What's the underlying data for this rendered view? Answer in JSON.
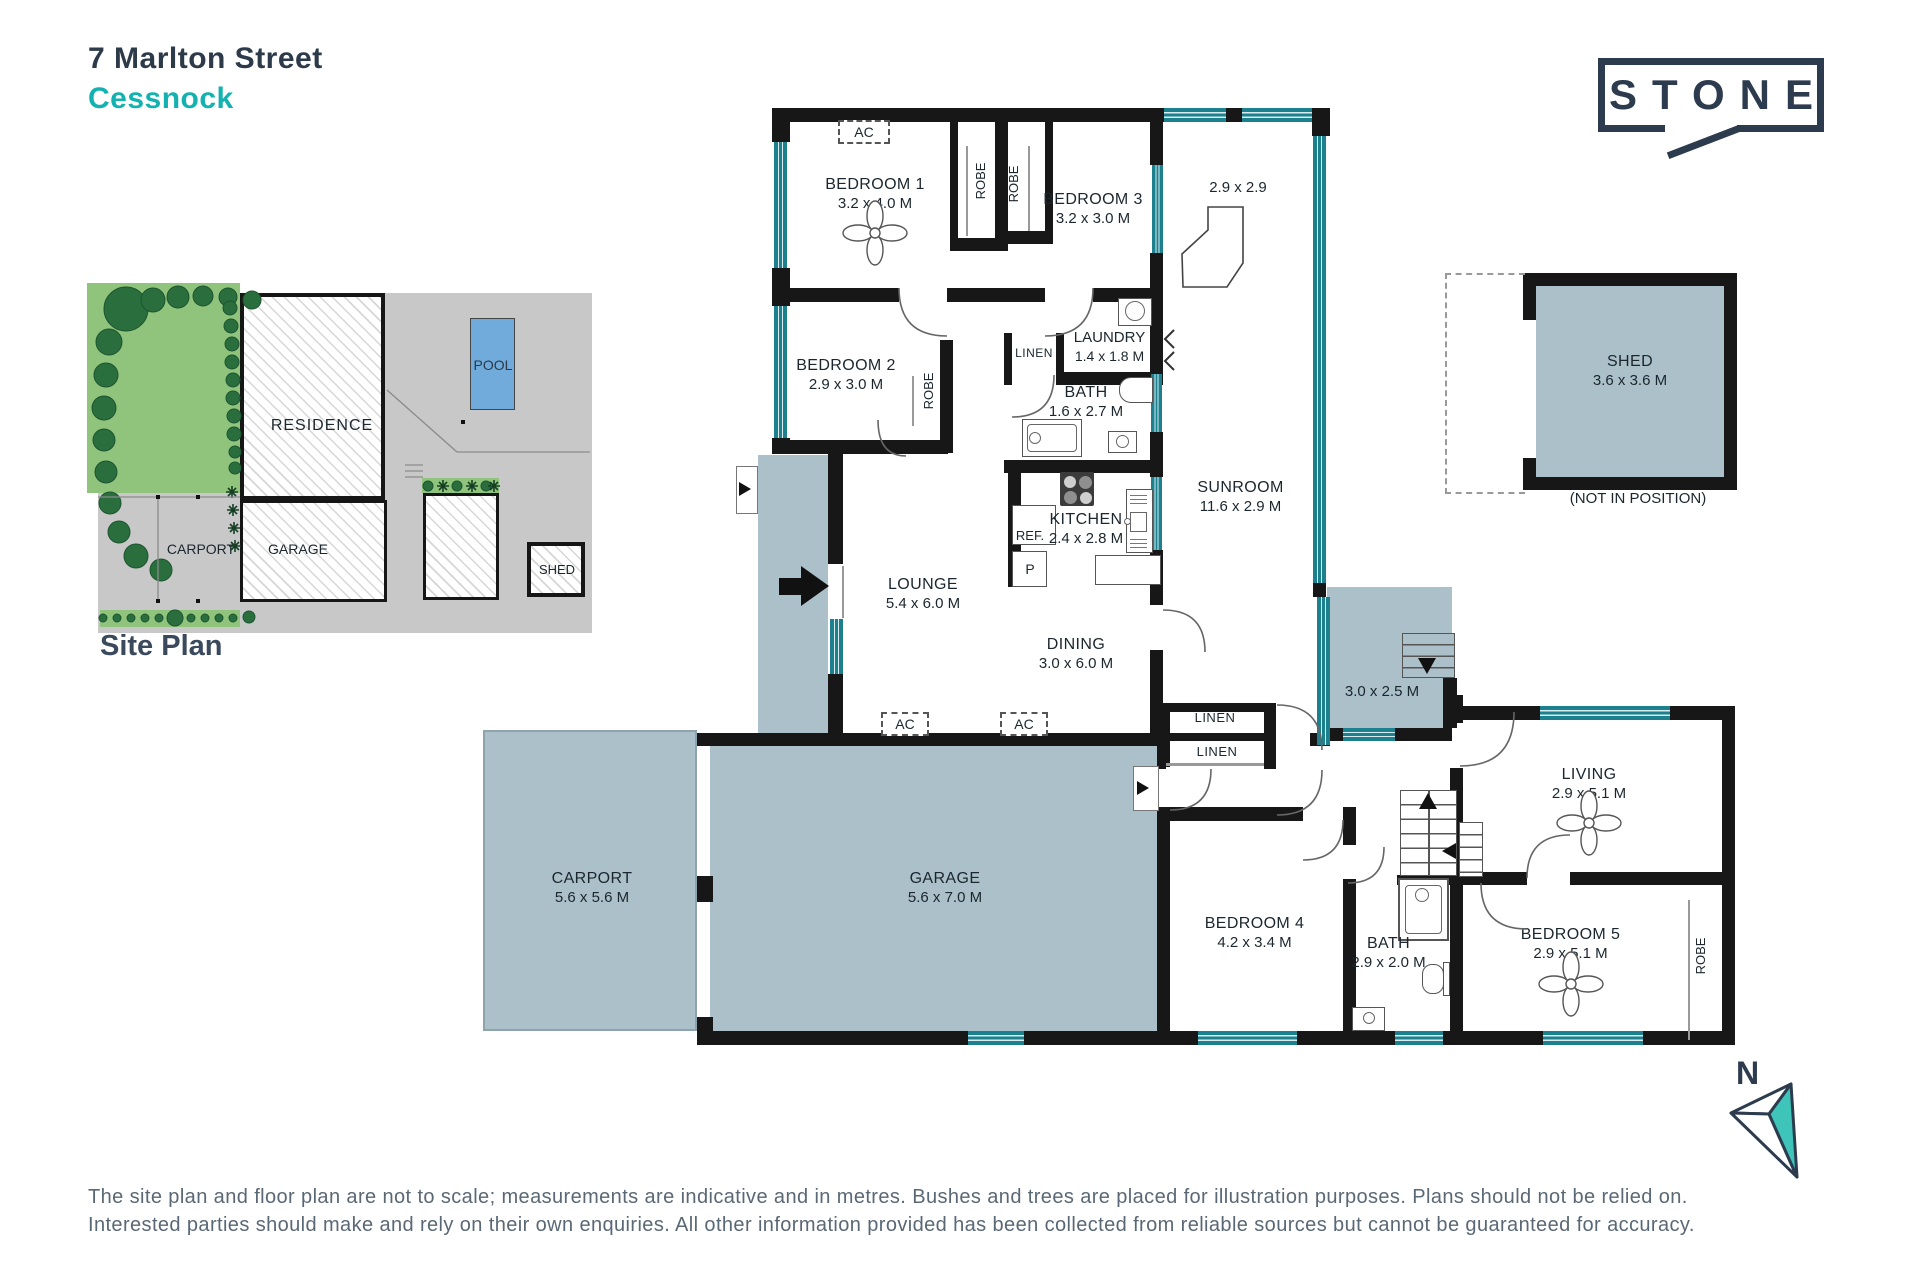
{
  "header": {
    "street": "7 Marlton Street",
    "suburb": "Cessnock"
  },
  "brand": {
    "name": "STONE"
  },
  "site_plan": {
    "title": "Site Plan",
    "residence": "RESIDENCE",
    "carport": "CARPORT",
    "garage": "GARAGE",
    "shed": "SHED",
    "pool": "POOL"
  },
  "floor_plan": {
    "rooms": [
      {
        "name": "BEDROOM 1",
        "dims": "3.2 x 4.0 M"
      },
      {
        "name": "BEDROOM 3",
        "dims": "3.2 x 3.0 M"
      },
      {
        "name": "BEDROOM 2",
        "dims": "2.9 x 3.0 M"
      },
      {
        "name": "LAUNDRY",
        "dims": "1.4 x 1.8 M"
      },
      {
        "name": "BATH",
        "dims": "1.6 x 2.7 M"
      },
      {
        "name": "KITCHEN",
        "dims": "2.4 x 2.8 M"
      },
      {
        "name": "SUNROOM",
        "dims": "11.6 x 2.9 M"
      },
      {
        "name": "LOUNGE",
        "dims": "5.4 x 6.0 M"
      },
      {
        "name": "DINING",
        "dims": "3.0 x 6.0 M"
      },
      {
        "name": "CARPORT",
        "dims": "5.6 x 5.6 M"
      },
      {
        "name": "GARAGE",
        "dims": "5.6 x 7.0 M"
      },
      {
        "name": "BEDROOM 4",
        "dims": "4.2 x 3.4 M"
      },
      {
        "name": "BATH",
        "dims": "2.9 x 2.0 M"
      },
      {
        "name": "LIVING",
        "dims": "2.9 x 5.1 M"
      },
      {
        "name": "BEDROOM 5",
        "dims": "2.9 x 5.1 M"
      }
    ],
    "bar_room_dims": "2.9 x 2.9",
    "bar": "BAR",
    "robe": "ROBE",
    "linen": "LINEN",
    "ac": "AC",
    "ref": "REF.",
    "pantry": "P",
    "deck_dims": "3.0 x 2.5 M",
    "shed": {
      "name": "SHED",
      "dims": "3.6 x 3.6 M",
      "note": "(NOT IN POSITION)"
    },
    "compass": "N"
  },
  "footer": {
    "line1": "The site plan and floor plan are not to scale; measurements are indicative and in metres. Bushes and trees are placed for illustration purposes. Plans should not be relied on.",
    "line2": "Interested parties should make and rely on their own enquiries. All other information provided has been collected from reliable sources but cannot be guaranteed for accuracy."
  },
  "colors": {
    "accent_teal": "#12b2b0",
    "navy": "#2d3b4e",
    "window_teal": "#1c808f",
    "fill_bluegray": "#abc0c8",
    "lawn_green": "#90c47c",
    "tree_green": "#2a6e3e",
    "pool_blue": "#70abdc"
  }
}
